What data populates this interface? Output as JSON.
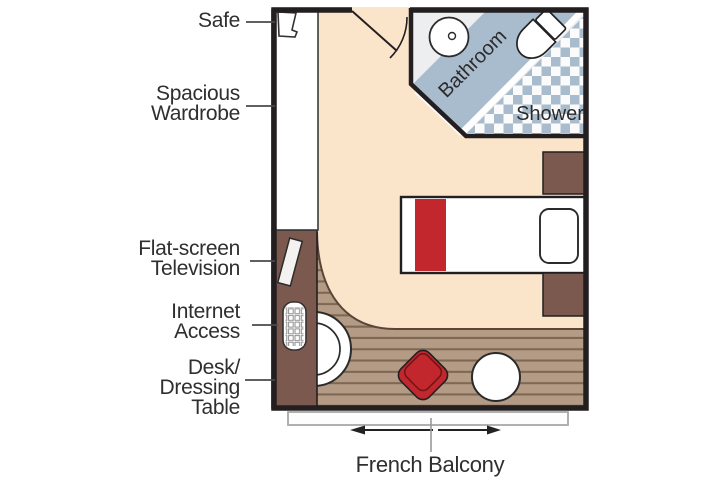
{
  "diagram": {
    "type": "stateroom-floorplan",
    "callouts": [
      {
        "id": "safe",
        "lines": [
          "Safe"
        ]
      },
      {
        "id": "wardrobe",
        "lines": [
          "Spacious",
          "Wardrobe"
        ]
      },
      {
        "id": "tv",
        "lines": [
          "Flat-screen",
          "Television"
        ]
      },
      {
        "id": "internet",
        "lines": [
          "Internet",
          "Access"
        ]
      },
      {
        "id": "desk",
        "lines": [
          "Desk/",
          "Dressing",
          "Table"
        ]
      }
    ],
    "rooms": {
      "bathroom": "Bathroom",
      "shower": "Shower"
    },
    "balcony": {
      "label": "French Balcony"
    },
    "colors": {
      "carpet": "#FAE5CB",
      "wood": "#B49B85",
      "wood_line": "#7E6753",
      "furniture_brown": "#7C594F",
      "accent_red": "#C1272D",
      "bath_blue": "#A9BCCE",
      "bath_floor": "#EDEEF0",
      "wall": "#231F20"
    }
  }
}
